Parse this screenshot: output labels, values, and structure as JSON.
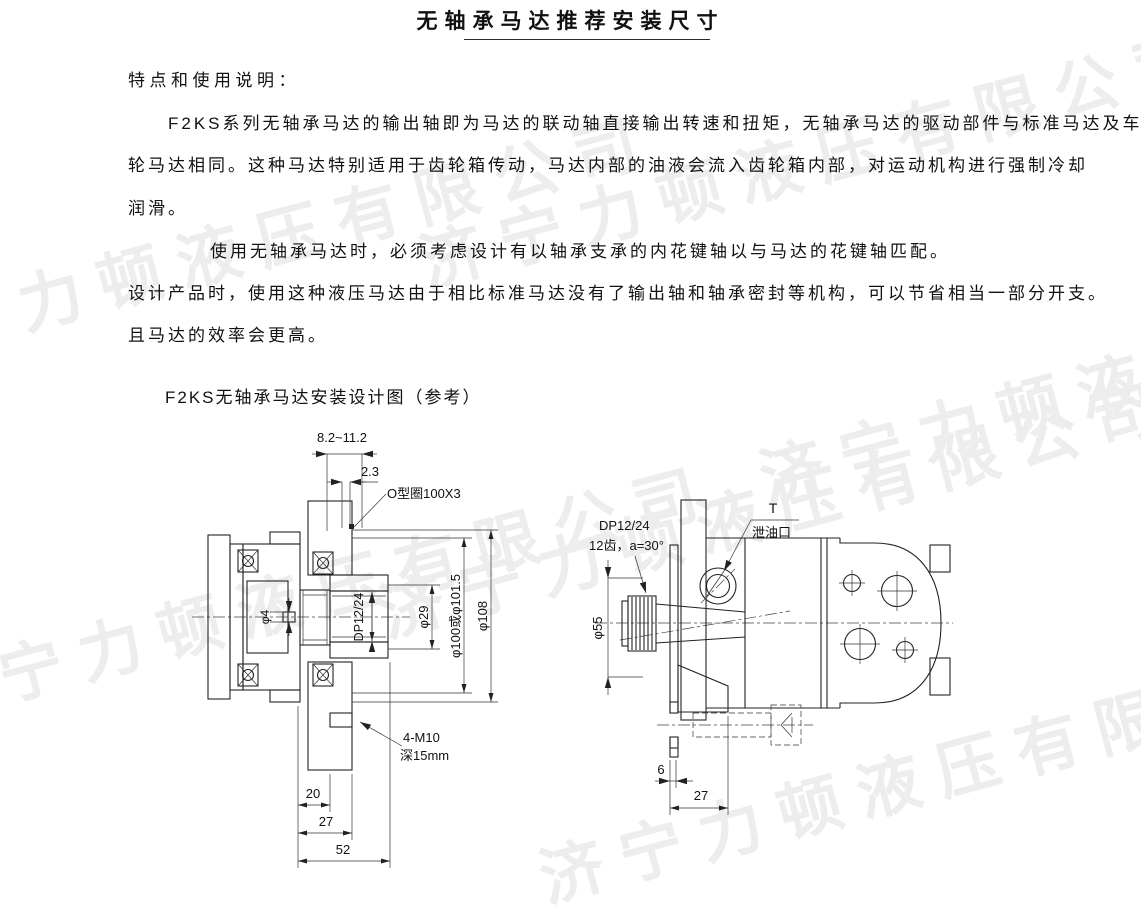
{
  "doc": {
    "title": "无轴承马达推荐安装尺寸",
    "heading": "特点和使用说明：",
    "para1": "F2KS系列无轴承马达的输出轴即为马达的联动轴直接输出转速和扭矩，无轴承马达的驱动部件与标准马达及车",
    "para2": "轮马达相同。这种马达特别适用于齿轮箱传动，马达内部的油液会流入齿轮箱内部，对运动机构进行强制冷却",
    "para3": "润滑。",
    "para4": "使用无轴承马达时，必须考虑设计有以轴承支承的内花键轴以与马达的花键轴匹配。",
    "para5": "设计产品时，使用这种液压马达由于相比标准马达没有了输出轴和轴承密封等机构，可以节省相当一部分开支。",
    "para6": "且马达的效率会更高。",
    "figure_caption": "F2KS无轴承马达安装设计图（参考）",
    "watermark": "济宁力顿液压有限公司"
  },
  "left_drawing": {
    "labels": {
      "top_range": "8.2~11.2",
      "offset": "2.3",
      "oring": "O型圈100X3",
      "dia4": "φ4",
      "spline": "DP12/24",
      "dia29": "φ29",
      "dia100": "φ100或φ101.5",
      "dia108": "φ108",
      "bolts": "4-M10",
      "bolt_depth": "深15mm",
      "d20": "20",
      "d27": "27",
      "d52": "52"
    }
  },
  "right_drawing": {
    "labels": {
      "spline": "DP12/24",
      "spline_teeth": "12齿，a=30°",
      "port": "T",
      "port_name": "泄油口",
      "dia55": "φ55",
      "d6": "6",
      "d27": "27"
    }
  }
}
